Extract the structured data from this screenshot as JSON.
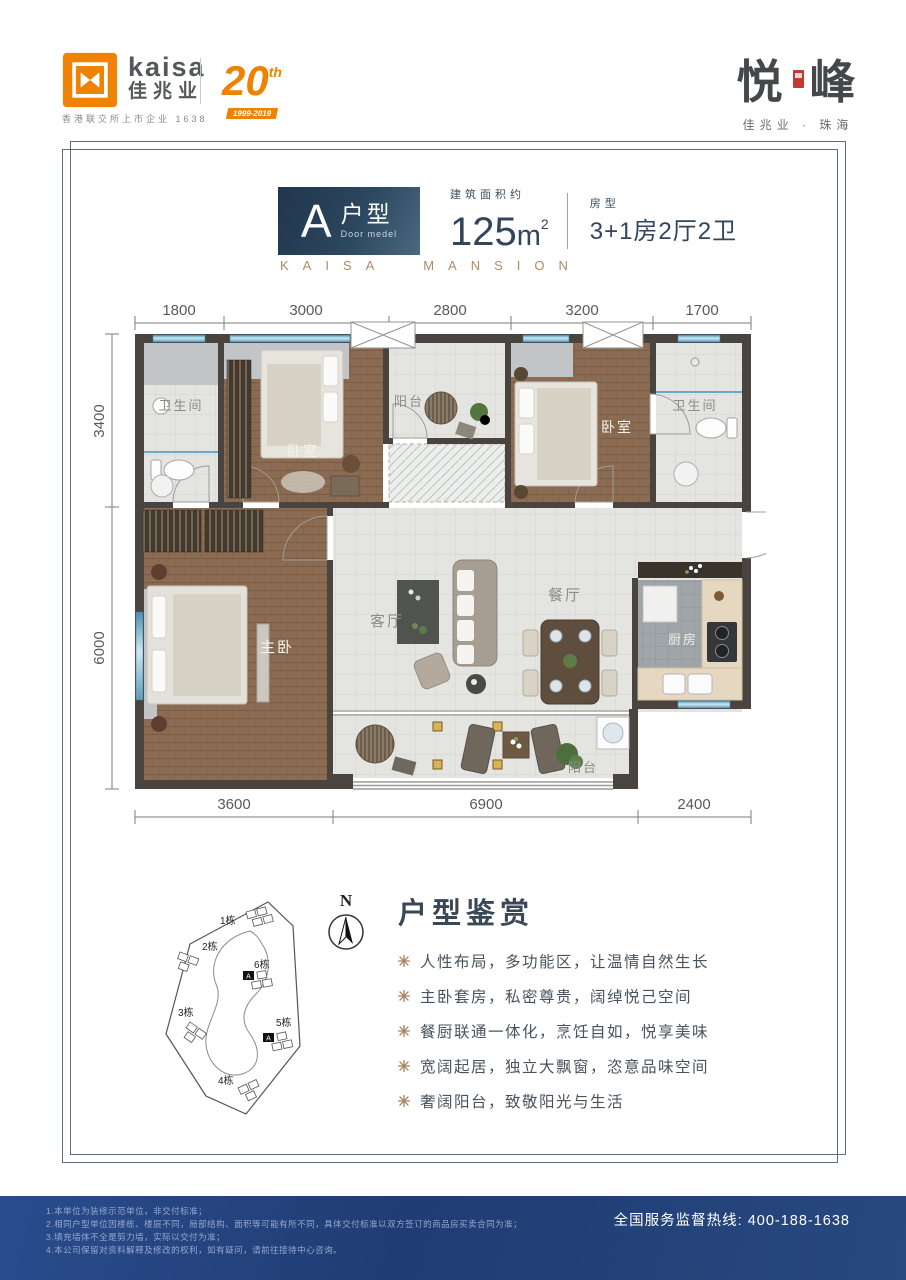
{
  "header": {
    "logo": {
      "latin": "kaisa",
      "cn": "佳兆业",
      "tagline": "香港联交所上市企业 1638",
      "anniv_number": "20",
      "anniv_sup": "th",
      "anniv_years": "1999-2019"
    },
    "project": {
      "name_left": "悦",
      "name_right": "峰",
      "subtitle": "佳兆业 · 珠海"
    }
  },
  "title_block": {
    "unit_letter": "A",
    "unit_cn": "户型",
    "unit_en": "Door medel",
    "area_label": "建筑面积约",
    "area_value": "125",
    "area_unit": "m",
    "area_exp": "2",
    "type_label": "房型",
    "type_value": "3+1房2厅2卫",
    "brand_caption": "KAISA MANSION"
  },
  "floor_plan": {
    "dims_top": [
      "1800",
      "3000",
      "2800",
      "3200",
      "1700"
    ],
    "dims_left": [
      "3400",
      "6000"
    ],
    "dims_bottom": [
      "3600",
      "6900",
      "2400"
    ],
    "rooms": {
      "bath1": "卫生间",
      "bed1": "卧室",
      "balcony_top": "阳台",
      "bed2": "卧室",
      "bath2": "卫生间",
      "master": "主卧",
      "living": "客厅",
      "dining": "餐厅",
      "kitchen": "厨房",
      "balcony_bottom": "阳台"
    }
  },
  "site_plan": {
    "compass": "N",
    "buildings": [
      "1栋",
      "2栋",
      "3栋",
      "4栋",
      "5栋",
      "6栋"
    ],
    "unit_marker": "A"
  },
  "appreciation": {
    "heading": "户型鉴赏",
    "bullets": [
      "人性布局，多功能区，让温情自然生长",
      "主卧套房，私密尊贵，阔绰悦己空间",
      "餐厨联通一体化，烹饪自如，悦享美味",
      "宽阔起居，独立大飘窗，恣意品味空间",
      "奢阔阳台，致敬阳光与生活"
    ]
  },
  "footer": {
    "notes": [
      "1.本单位为装修示范单位，非交付标准；",
      "2.相同户型单位因楼栋、楼层不同，局部结构、面积等可能有所不同，具体交付标准以双方签订的商品房买卖合同为准；",
      "3.填充墙体不全是剪力墙，实际以交付为准；",
      "4.本公司保留对资料解释及修改的权利，如有疑问，请前往接待中心咨询。"
    ],
    "hotline_label": "全国服务监督热线:",
    "hotline_number": "400-188-1638"
  },
  "colors": {
    "accent_orange": "#ef8200",
    "title_navy": "#31465c",
    "gold": "#b48a63",
    "seal_red": "#c23b30",
    "footer_navy": "#203c74",
    "wall": "#4a4440",
    "window_blue": "#5e9dbd"
  }
}
